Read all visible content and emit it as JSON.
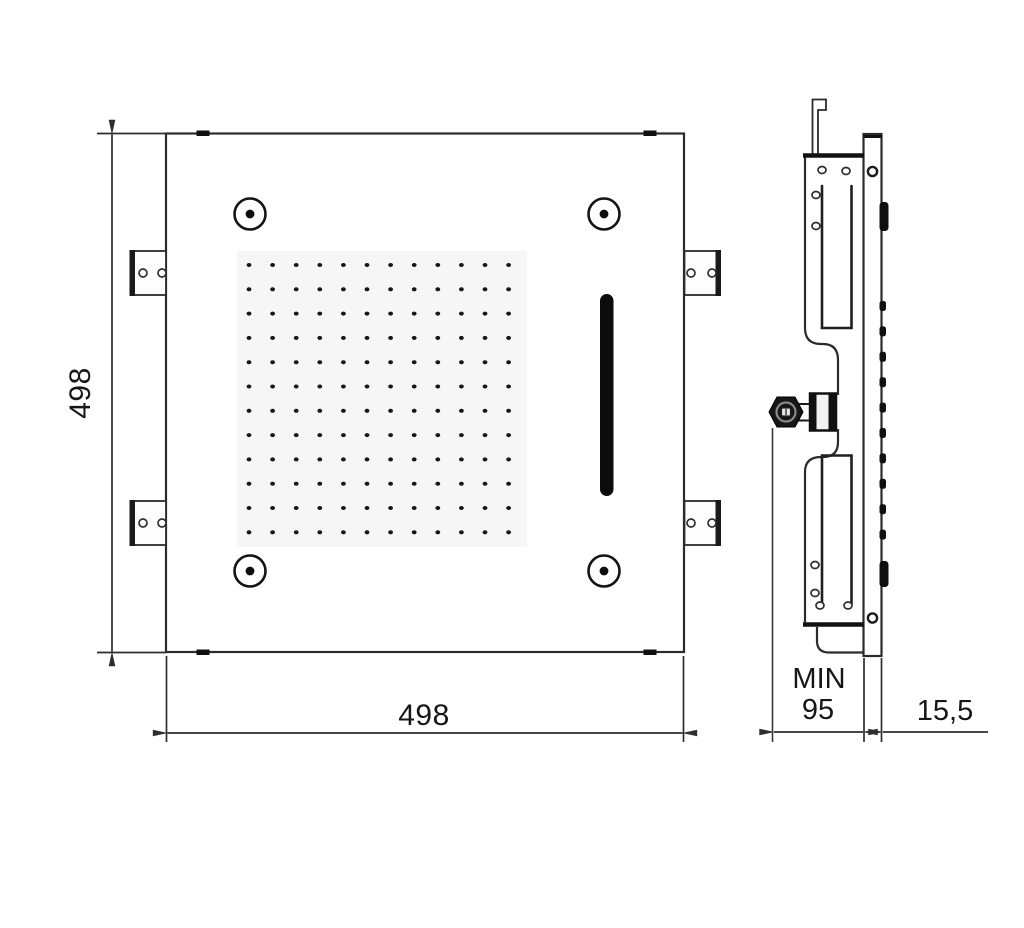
{
  "drawing": {
    "type": "technical-dimension-drawing",
    "subject": "square-recessed-ceiling-shower-head",
    "colors": {
      "background": "#ffffff",
      "line": "#2b2b2b",
      "dark_fill": "#101010",
      "grid_wash": "#f6f6f6"
    },
    "front_view": {
      "height_dim": "498",
      "width_dim": "498",
      "nozzle_grid": {
        "rows": 12,
        "cols": 12
      },
      "corner_screw_count": 4,
      "mounting_bracket_count": 4,
      "edge_clip_count": 4,
      "features": [
        "nozzle-grid",
        "waterfall-slot",
        "corner-screws",
        "side-mounting-brackets"
      ]
    },
    "side_view": {
      "recess_depth_label_line1": "MIN",
      "recess_depth_label_line2": "95",
      "plate_thickness_label": "15,5",
      "nozzle_nub_count": 10,
      "features": [
        "face-plate",
        "mounting-frame",
        "hanging-hook",
        "water-inlet-fitting"
      ]
    }
  }
}
